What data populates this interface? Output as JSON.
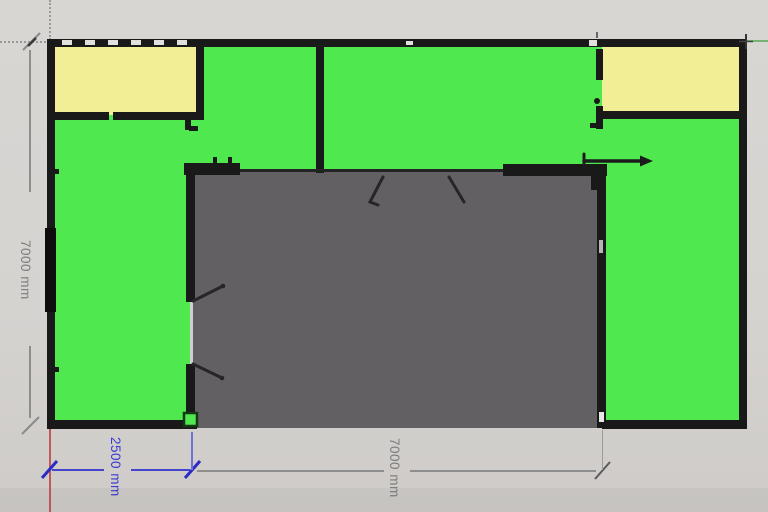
{
  "scene": {
    "type": "floor-plan-canvas",
    "units": "mm",
    "description": "Top-down floor plan with two yellow rooms, green floor areas, and a gray central court open at the bottom"
  },
  "dims": {
    "left": {
      "label": "7000 mm",
      "orientation": "vertical",
      "color": "#7e7e7e"
    },
    "bottom_left": {
      "label": "2500 mm",
      "orientation": "horizontal",
      "color": "#3c3cd0"
    },
    "bottom_center": {
      "label": "7000 mm",
      "orientation": "horizontal",
      "color": "#7e7e7e"
    }
  },
  "rooms": {
    "green_floor": {
      "color": "#4fe94f"
    },
    "yellow_top_left": {
      "color": "#f2ee96"
    },
    "yellow_top_right": {
      "color": "#f2ee96"
    },
    "gray_court": {
      "color": "#636063"
    }
  },
  "colors": {
    "background": "#d5d3d0",
    "wall": "#191919",
    "axis_red": "#c25959",
    "axis_green": "#77b377",
    "dimension_blue": "#3c3cd0",
    "dimension_gray": "#8e8e8e"
  }
}
